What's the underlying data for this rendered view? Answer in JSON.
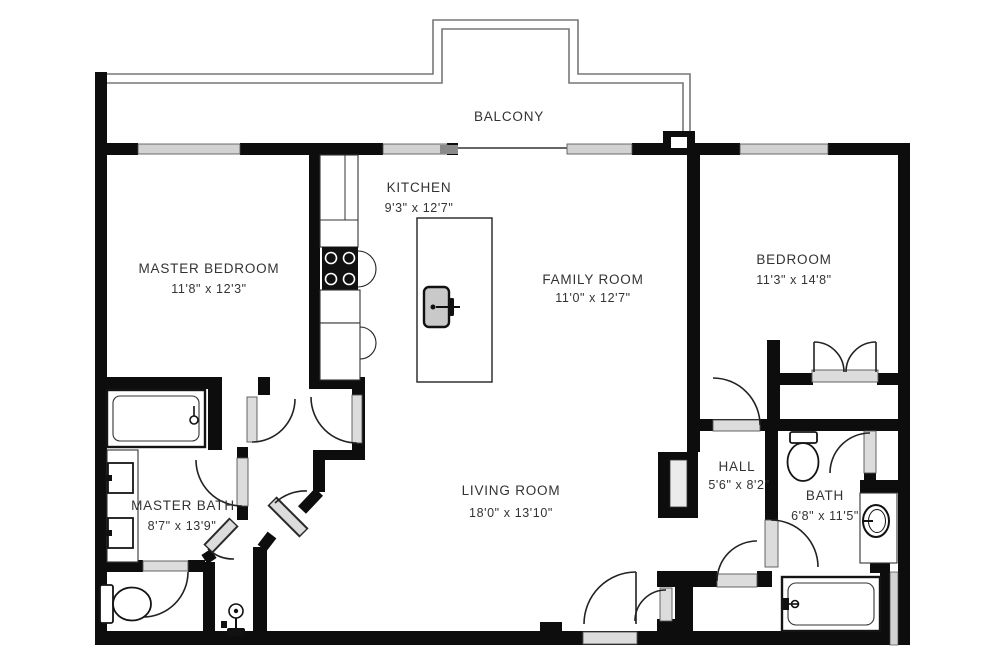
{
  "balcony": {
    "label": "BALCONY"
  },
  "rooms": {
    "master_bedroom": {
      "name": "MASTER BEDROOM",
      "dims": "11'8\" x 12'3\""
    },
    "kitchen": {
      "name": "KITCHEN",
      "dims": "9'3\" x 12'7\""
    },
    "family_room": {
      "name": "FAMILY ROOM",
      "dims": "11'0\" x 12'7\""
    },
    "bedroom": {
      "name": "BEDROOM",
      "dims": "11'3\" x 14'8\""
    },
    "master_bath": {
      "name": "MASTER BATH",
      "dims": "8'7\" x 13'9\""
    },
    "living_room": {
      "name": "LIVING ROOM",
      "dims": "18'0\" x 13'10\""
    },
    "hall": {
      "name": "HALL",
      "dims": "5'6\" x 8'2\""
    },
    "bath": {
      "name": "BATH",
      "dims": "6'8\" x 11'5\""
    }
  },
  "colors": {
    "wall": "#0d0d0d",
    "window_fill": "#d2d2d2",
    "door_leaf": "#dcdcdc",
    "rail": "#777777",
    "text": "#333333",
    "appliance": "#111111",
    "niche_fill": "#ebebeb"
  }
}
